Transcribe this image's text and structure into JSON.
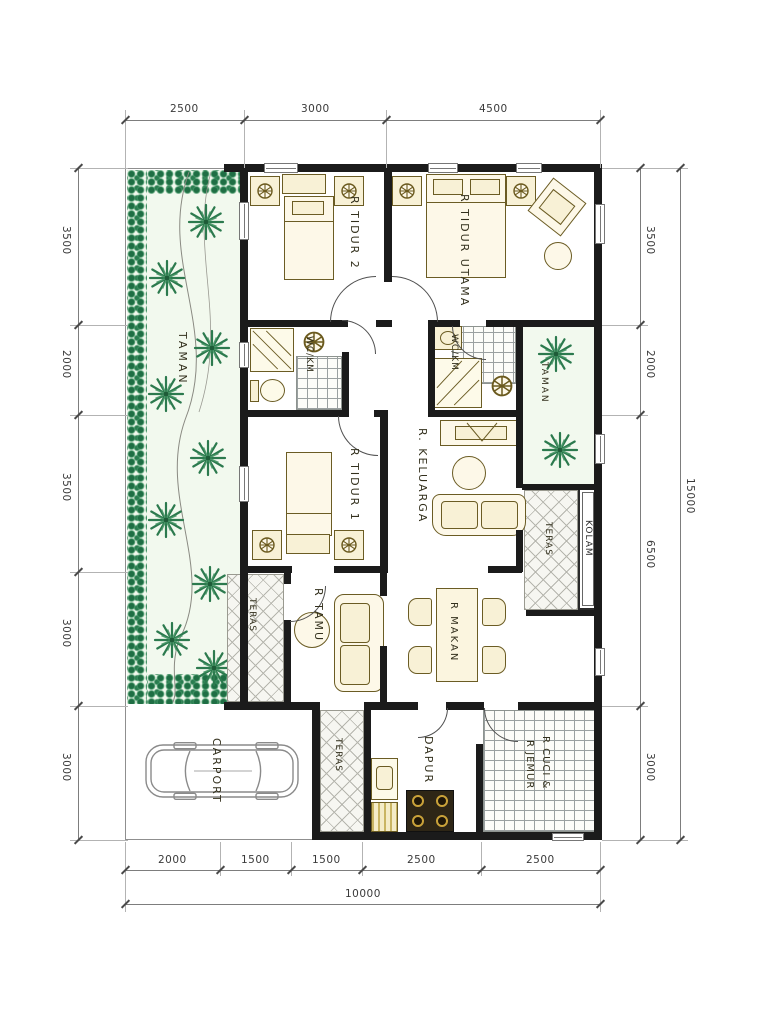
{
  "drawing": {
    "type": "house floor plan"
  },
  "dimensions": {
    "top": [
      "2500",
      "3000",
      "4500"
    ],
    "left": [
      "3500",
      "2000",
      "3500",
      "3000",
      "3000"
    ],
    "right": [
      "3500",
      "2000",
      "6500",
      "3000"
    ],
    "right_total": "15000",
    "bottom": [
      "2000",
      "1500",
      "1500",
      "2500",
      "2500"
    ],
    "bottom_total": "10000"
  },
  "rooms": {
    "taman_left": "TAMAN",
    "taman_right": "TAMAN",
    "tidur2": "R TIDUR 2",
    "tidur_utama": "R TIDUR UTAMA",
    "wc_km_left": "WC/KM",
    "wc_km_right": "WC/KM",
    "tidur1": "R TIDUR 1",
    "keluarga": "R. KELUARGA",
    "kolam": "KOLAM",
    "teras_right": "TERAS",
    "teras_left": "TERAS",
    "teras_front": "TERAS",
    "tamu": "R TAMU",
    "makan": "R MAKAN",
    "carport": "CARPORT",
    "dapur": "DAPUR",
    "cuci_jemur_line1": "R CUCI &",
    "cuci_jemur_line2": "R JEMUR"
  },
  "colors": {
    "wall": "#1b1b1b",
    "plant": "#2c7a4e",
    "furniture_fill": "#f8f1d6",
    "furniture_line": "#6b5c24",
    "dimension_line": "#7d7d7d"
  }
}
